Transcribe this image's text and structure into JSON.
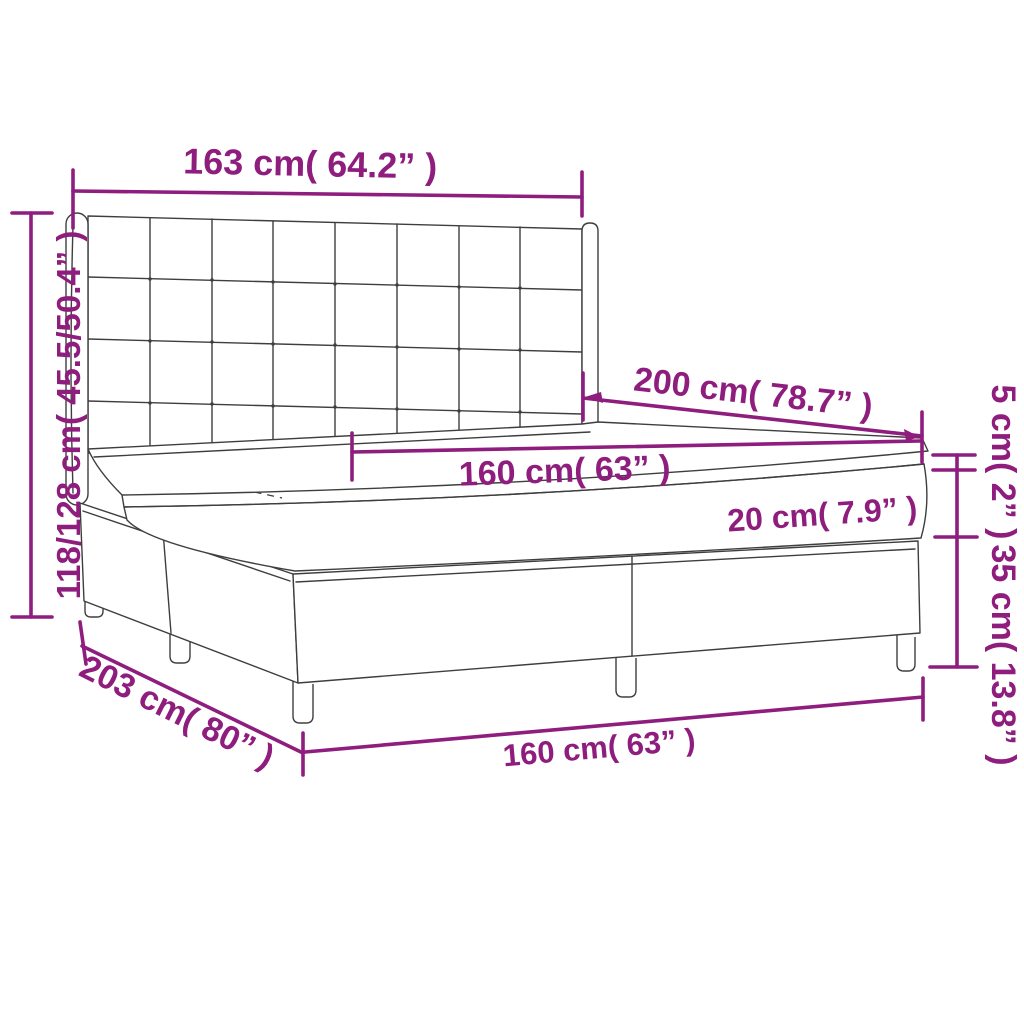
{
  "diagram": {
    "type": "product-dimension-diagram",
    "subject": "box spring bed with tufted headboard",
    "colors": {
      "dimension": "#8e1d7e",
      "line_art": "#3e3e3e",
      "background": "#ffffff"
    },
    "labels": {
      "headboard_width": "163 cm( 64.2” )",
      "overall_height": "118/128 cm( 45.5/50.4” )",
      "length_top": "200 cm( 78.7” )",
      "mattress_width": "160 cm( 63” )",
      "topper_height": "5 cm( 2” )",
      "mattress_height": "20 cm( 7.9” )",
      "base_height": "35 cm( 13.8” )",
      "overall_length": "203 cm( 80” )",
      "width_bottom": "160 cm( 63” )"
    }
  }
}
